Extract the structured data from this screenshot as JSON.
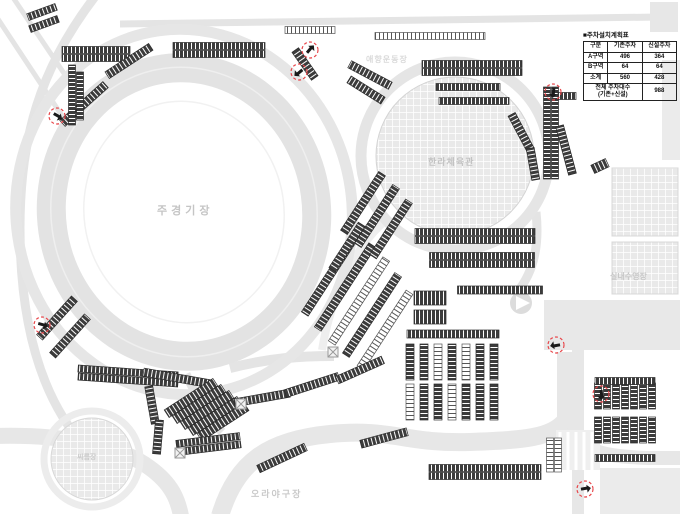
{
  "colors": {
    "marker_red": "#e8474b",
    "parking_dark": "#3c3c3c",
    "road_gray": "#e3e3e3"
  },
  "plan_table": {
    "title": "■주차설치계획표",
    "headers": [
      "구분",
      "기존주차",
      "신설주차"
    ],
    "rows": [
      {
        "zone": "A구역",
        "existing": "496",
        "new": "364"
      },
      {
        "zone": "B구역",
        "existing": "64",
        "new": "64"
      },
      {
        "zone": "소계",
        "existing": "560",
        "new": "428"
      }
    ],
    "total_label_line1": "전체 주차대수",
    "total_label_line2": "(기존+신설)",
    "total_value": "988"
  },
  "map_labels": {
    "main_stadium": "주경기장",
    "gymnasium": "한라체육관",
    "aux_field": "애향운동장",
    "indoor_pool": "실내수영장",
    "baseball_field": "오라야구장",
    "ssireum_arena": "씨름장"
  }
}
